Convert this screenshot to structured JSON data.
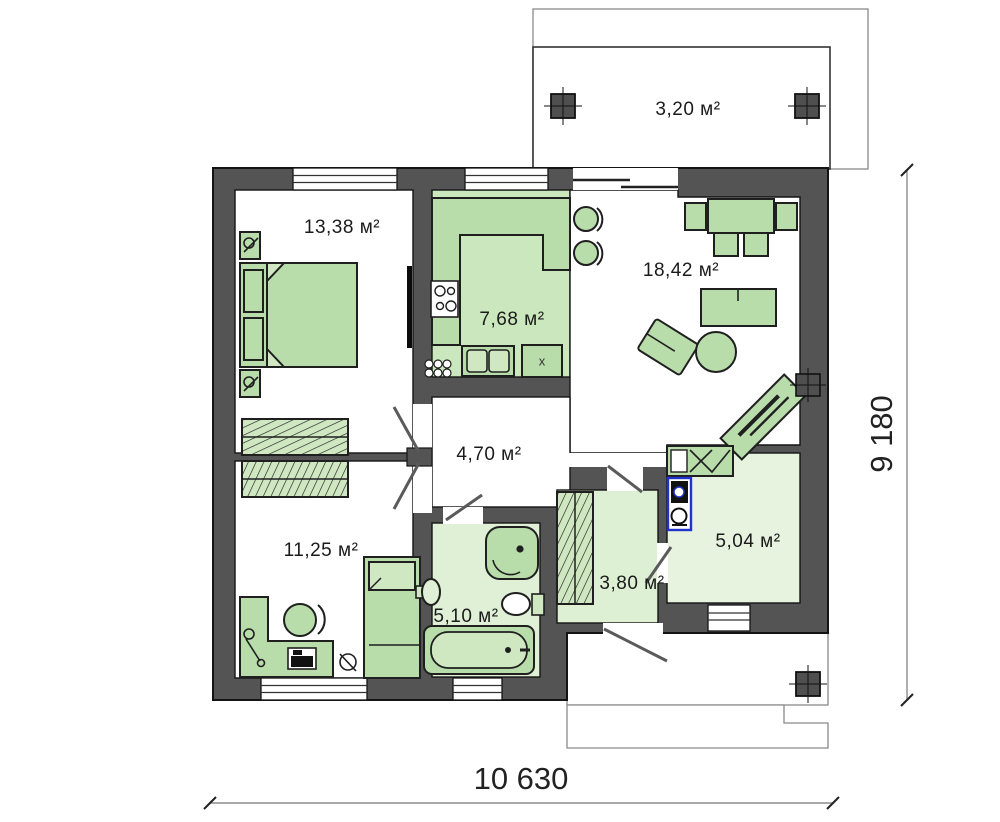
{
  "rooms": [
    {
      "id": "terrace",
      "area_label": "3,20 м²"
    },
    {
      "id": "bedroom-1",
      "area_label": "13,38 м²"
    },
    {
      "id": "kitchen",
      "area_label": "7,68 м²"
    },
    {
      "id": "living-room",
      "area_label": "18,42 м²"
    },
    {
      "id": "hallway",
      "area_label": "4,70 м²"
    },
    {
      "id": "bedroom-2",
      "area_label": "11,25 м²"
    },
    {
      "id": "bathroom",
      "area_label": "5,10 м²"
    },
    {
      "id": "wardrobe-hall",
      "area_label": "3,80 м²"
    },
    {
      "id": "bathroom-2",
      "area_label": "5,04 м²"
    }
  ],
  "dimensions": {
    "width_label": "10 630",
    "height_label": "9 180"
  },
  "kitchen": {
    "appliance_marker": "x"
  },
  "colors": {
    "wall": "#545454",
    "outline": "#141414",
    "furniture_green": "#b9dcab",
    "kitchen_floor": "#cbe7bd",
    "light_floor": "#def0d4",
    "lighter_floor": "#e7f3df",
    "appliance_accent": "#2233cc"
  }
}
